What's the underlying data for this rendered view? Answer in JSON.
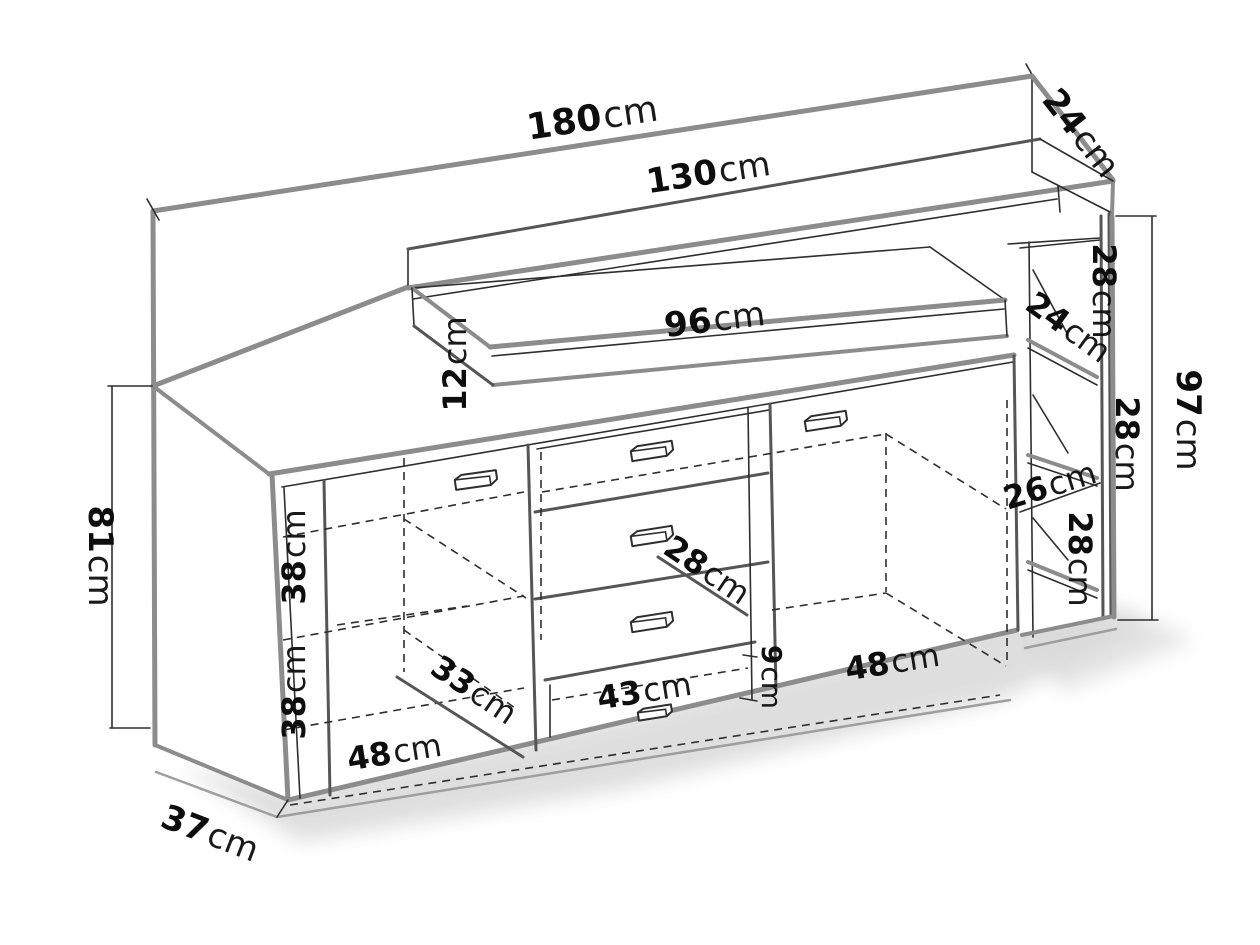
{
  "diagram": {
    "kind": "furniture dimension line-drawing",
    "unit": "cm",
    "colors": {
      "background": "#ffffff",
      "edge_strong": "#8c8c8c",
      "edge_detail": "#2e2e2e",
      "text": "#0d0d0d",
      "shadow": "#d9d9d9"
    }
  },
  "labels": {
    "total_width": {
      "num": "180",
      "unit": "cm"
    },
    "upper_width": {
      "num": "130",
      "unit": "cm"
    },
    "top_depth": {
      "num": "24",
      "unit": "cm"
    },
    "shelf_width": {
      "num": "96",
      "unit": "cm"
    },
    "shelf_height": {
      "num": "12",
      "unit": "cm"
    },
    "cubby_top_height": {
      "num": "28",
      "unit": "cm"
    },
    "cubby_shelf_depth": {
      "num": "24",
      "unit": "cm"
    },
    "cubby_mid_height": {
      "num": "28",
      "unit": "cm"
    },
    "cubby_width": {
      "num": "26",
      "unit": "cm"
    },
    "cubby_bottom_height": {
      "num": "28",
      "unit": "cm"
    },
    "total_height_right": {
      "num": "97",
      "unit": "cm"
    },
    "cabinet_height": {
      "num": "81",
      "unit": "cm"
    },
    "shelf_gap_upper": {
      "num": "38",
      "unit": "cm"
    },
    "shelf_gap_lower": {
      "num": "38",
      "unit": "cm"
    },
    "interior_depth": {
      "num": "33",
      "unit": "cm"
    },
    "left_door_width": {
      "num": "48",
      "unit": "cm"
    },
    "drawer_height": {
      "num": "28",
      "unit": "cm"
    },
    "bottom_drawer_width": {
      "num": "43",
      "unit": "cm"
    },
    "bottom_drawer_height": {
      "num": "9",
      "unit": "cm"
    },
    "right_door_width": {
      "num": "48",
      "unit": "cm"
    },
    "cabinet_depth": {
      "num": "37",
      "unit": "cm"
    }
  }
}
